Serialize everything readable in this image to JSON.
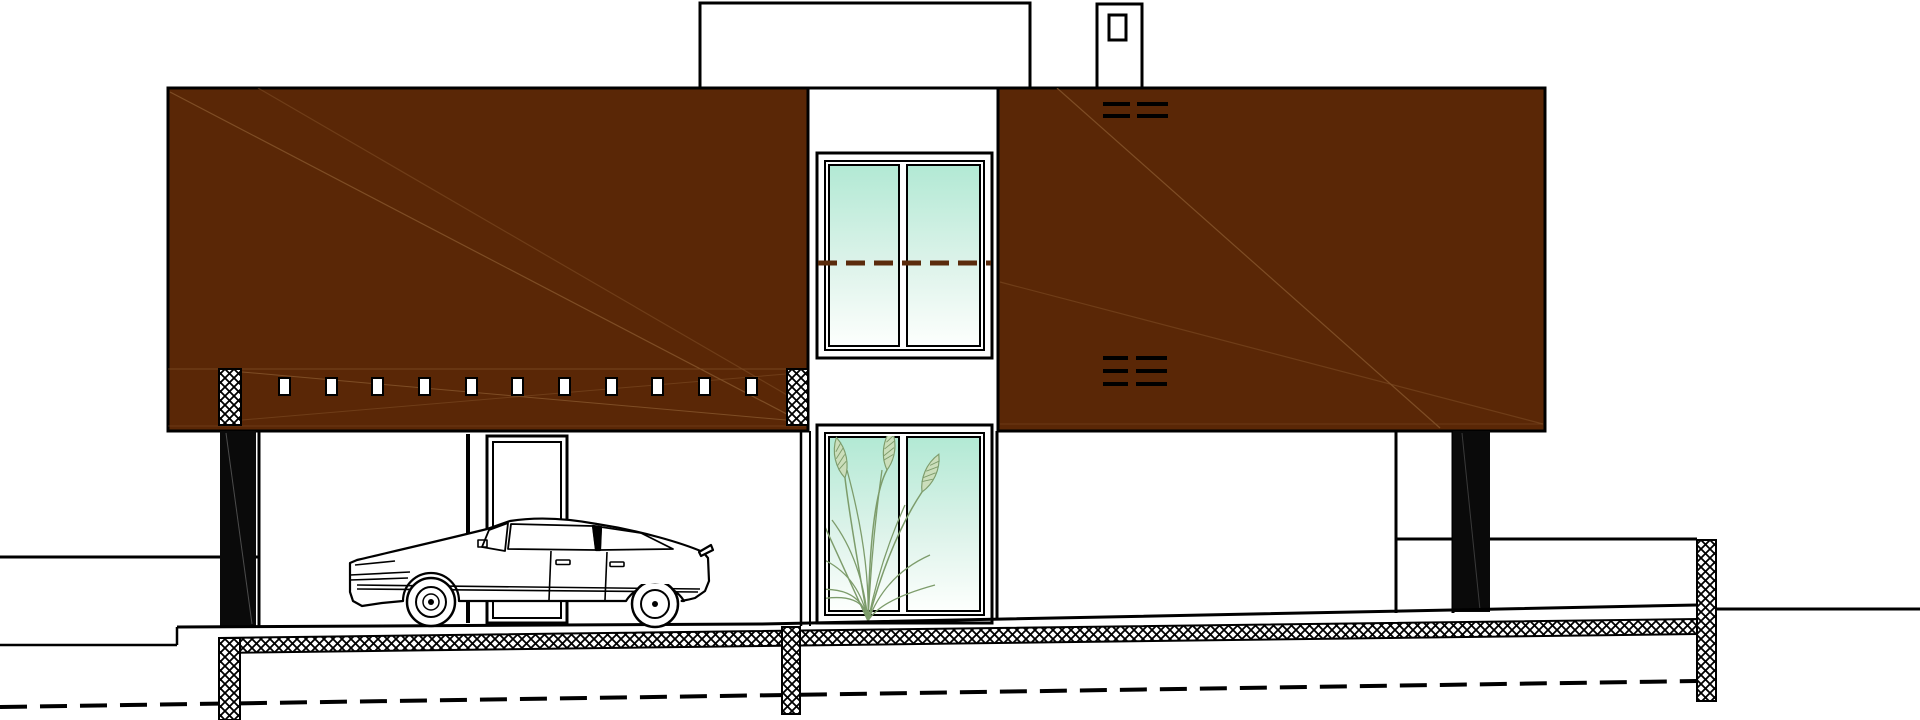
{
  "meta": {
    "drawing_type": "architectural street elevation / section of a two-storey house with carport",
    "visible_text": "none"
  },
  "colors": {
    "background": "#ffffff",
    "ink": "#000000",
    "facade": "#5a2706",
    "facade_scratch": "#8a5a30",
    "glass_top": "#b2e9d4",
    "glass_mid": "#ddf3ea",
    "glass_bottom": "#fdfffd",
    "section_dash": "#5a2b0c",
    "plant_stroke": "#7d9c6b",
    "plant_fill": "#cbdebb",
    "shadow_black": "#0a0a0a"
  },
  "facade": {
    "left_panel_slot_count": 11,
    "hatch_column_count": 2,
    "upper_vent_groups": 2,
    "upper_vent_lines_per_group": 2,
    "lower_vent_groups": 2,
    "lower_vent_lines_per_group": 3
  },
  "windows": {
    "count": 2,
    "panes_per_window": 2,
    "upper_has_section_dash": true,
    "lower_has_plant": true
  },
  "site": {
    "car_present": true,
    "car_style": "citroen-cx-profile",
    "foundation_piers": 2,
    "retaining_wall": true,
    "frost_line_dashed": true
  }
}
